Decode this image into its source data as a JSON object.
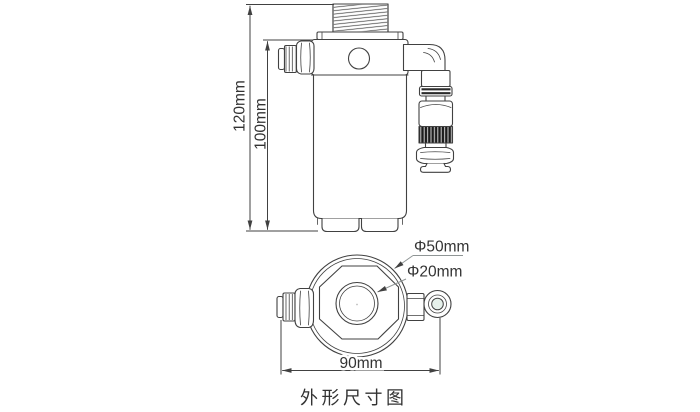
{
  "caption": "外形尺寸图",
  "front_view": {
    "overall_height": "120mm",
    "body_height": "100mm"
  },
  "top_view": {
    "outer_diameter": "Φ50mm",
    "port_diameter": "Φ20mm",
    "overall_width": "90mm"
  },
  "colors": {
    "background": "#ffffff",
    "line": "#414141",
    "leader": "#8f9595",
    "oring": "#2b2b2b",
    "knurl": "#1d1d1d",
    "eyelet_tint": "#e6f1eb",
    "text": "#333333"
  }
}
